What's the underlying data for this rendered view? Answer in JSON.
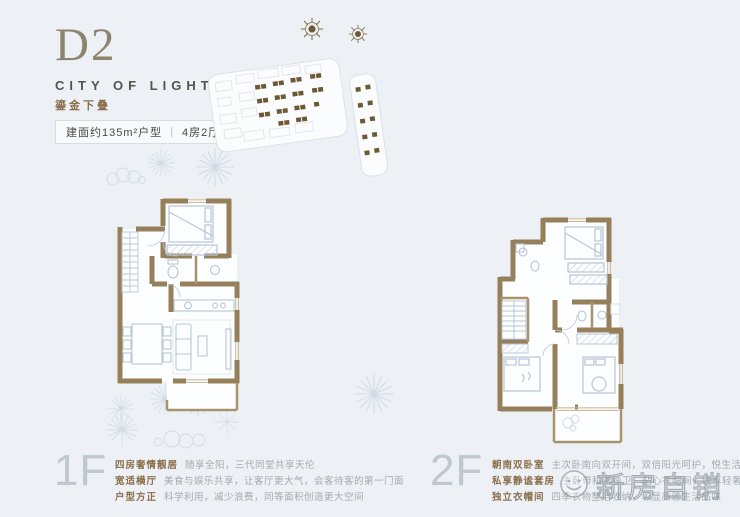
{
  "page": {
    "background": "#edf1f6"
  },
  "header": {
    "unit_code": "D2",
    "project_name": "CITY OF LIGHT",
    "product_tag": "鎏金下叠",
    "area_label": "建面约135m²户型",
    "divider": "|",
    "layout_label": "4房2厅3卫"
  },
  "site_plan": {
    "highlighted_unit_color": "#6d5a35",
    "outline_color": "#dde2e8"
  },
  "floors": [
    {
      "label": "1F",
      "features": [
        {
          "title": "四房奢情靓居",
          "desc": "随享全阳，三代同堂共享天伦"
        },
        {
          "title": "宽适横厅",
          "desc": "美食与娱乐共享，让客厅更大气，会客待客的第一门面"
        },
        {
          "title": "户型方正",
          "desc": "科学利用，减少浪费，同等面积创造更大空间"
        }
      ]
    },
    {
      "label": "2F",
      "features": [
        {
          "title": "朝南双卧室",
          "desc": "主次卧南向双开间，双倍阳光呵护，悦生活醉美空间"
        },
        {
          "title": "私享静谧套房",
          "desc": "主卧带私密独卫，贴心衣帽间，悦享轻奢生活品质"
        },
        {
          "title": "独立衣帽间",
          "desc": "四季衣物整洁收纳，彰显高雅生活品味"
        }
      ]
    }
  ],
  "watermark": {
    "text": "新房自销"
  },
  "colors": {
    "wall": "#96805b",
    "wall_light": "#a8936c",
    "furniture_line": "#b7c6d6",
    "accent_brown": "#8a6e49",
    "floor_label_gray": "#bfc7cf",
    "background": "#edf1f6"
  }
}
